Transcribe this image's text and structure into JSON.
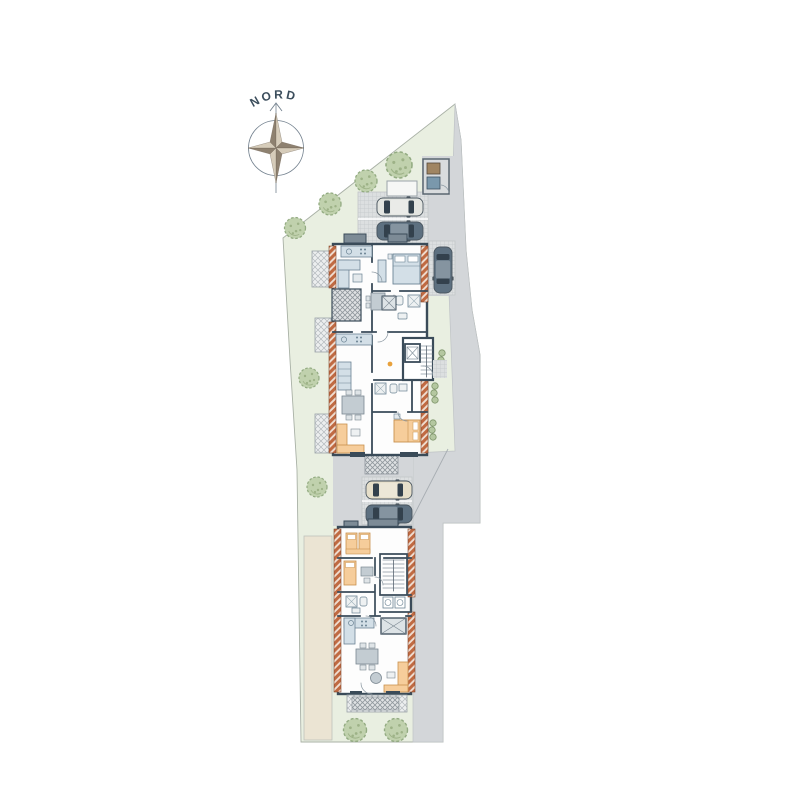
{
  "page": {
    "kind": "architectural-site-plan",
    "background": "#ffffff"
  },
  "compass": {
    "label": "NORD"
  },
  "colors": {
    "page_bg": "#ffffff",
    "site_green": "#e9efe1",
    "site_edge": "#a9b1a6",
    "driveway_gray": "#d3d6d9",
    "parking_gray": "#dcdfe0",
    "wall_dark": "#3a4b59",
    "brick": "#c06a42",
    "brick_line": "#f0ded2",
    "tree_fill": "#c0d1ad",
    "tree_edge": "#93ab82",
    "bush_fill": "#b4c7a0",
    "bush_edge": "#7d9469",
    "furn_blue": "#d3dfe7",
    "furn_blue_edge": "#6c8494",
    "furn_orange": "#f6cd9b",
    "furn_orange_edge": "#c8914f",
    "car_dark": "#5d7080",
    "car_silver": "#e3e5e1",
    "car_beige": "#e6dfca",
    "car_window": "#33414d",
    "beige_strip": "#ebe4d3",
    "bin_brown": "#a08562",
    "bin_blue": "#7a98ac",
    "compass_light": "#d6ccba",
    "compass_dark": "#8e8170",
    "label_color": "#3b4d5c",
    "accent_orange_dot": "#e8a13c"
  },
  "icons": {
    "compass": "compass-rose-icon",
    "tree": "tree-icon",
    "bush": "shrub-icon",
    "car": "car-top-view-icon",
    "bin": "waste-bin-icon",
    "stairs": "stairs-icon",
    "elevator": "elevator-icon"
  },
  "inventory": {
    "buildings": 2,
    "large_trees": 8,
    "small_bushes": 9,
    "cars": 5,
    "parking_stalls": 5,
    "waste_bins": 2,
    "balconies_upper_building": 3,
    "terraces_hatched": 3
  }
}
